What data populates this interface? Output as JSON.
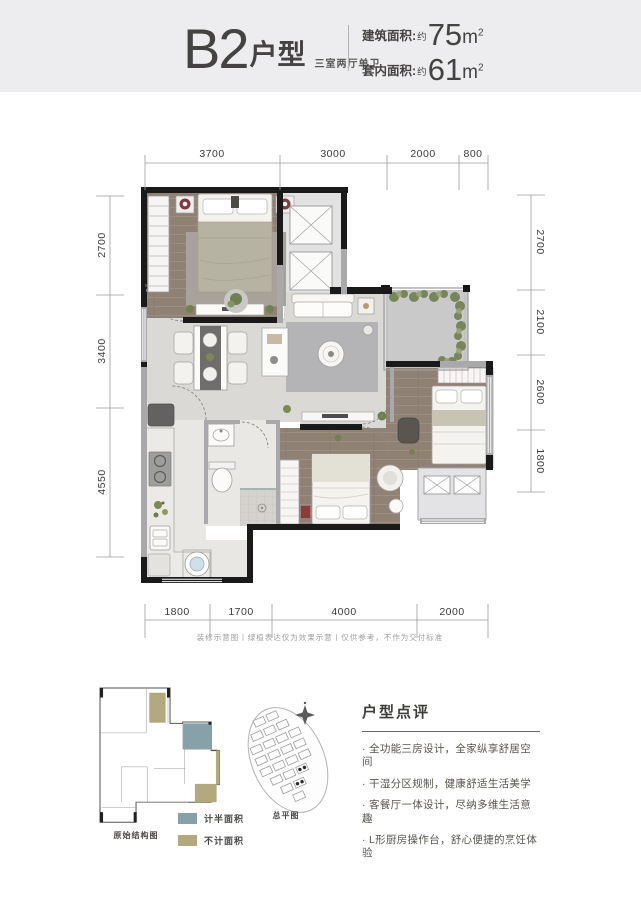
{
  "header": {
    "title_code": "B2",
    "title_type": "户型",
    "subtitle": "三室两厅单卫",
    "areas": [
      {
        "label": "建筑面积:",
        "approx": "约",
        "value": "75",
        "unit_base": "m",
        "unit_sup": "2"
      },
      {
        "label": "套内面积:",
        "approx": "约",
        "value": "61",
        "unit_base": "m",
        "unit_sup": "2"
      }
    ]
  },
  "floor_plan": {
    "dimensions": {
      "top": [
        "3700",
        "3000",
        "2000",
        "800"
      ],
      "bottom": [
        "1800",
        "1700",
        "4000",
        "2000"
      ],
      "left": [
        "2700",
        "3400",
        "4550"
      ],
      "right": [
        "2700",
        "2100",
        "2600",
        "1800"
      ]
    },
    "disclaimer": "装修示意图丨绿植表达仅为效果示意丨仅供参考，不作为交付标准"
  },
  "footer": {
    "structure_caption": "原始结构图",
    "siteplan_caption": "总平图",
    "legend": [
      {
        "label": "计半面积",
        "color": "#87a1a9"
      },
      {
        "label": "不计面积",
        "color": "#b2a97f"
      }
    ],
    "review": {
      "title": "户型点评",
      "bullets": [
        "全功能三房设计，全家纵享舒居空间",
        "干湿分区规制，健康舒适生活美学",
        "客餐厅一体设计，尽纳多维生活意趣",
        "L形厨房操作台，舒心便捷的烹饪体验"
      ]
    }
  }
}
